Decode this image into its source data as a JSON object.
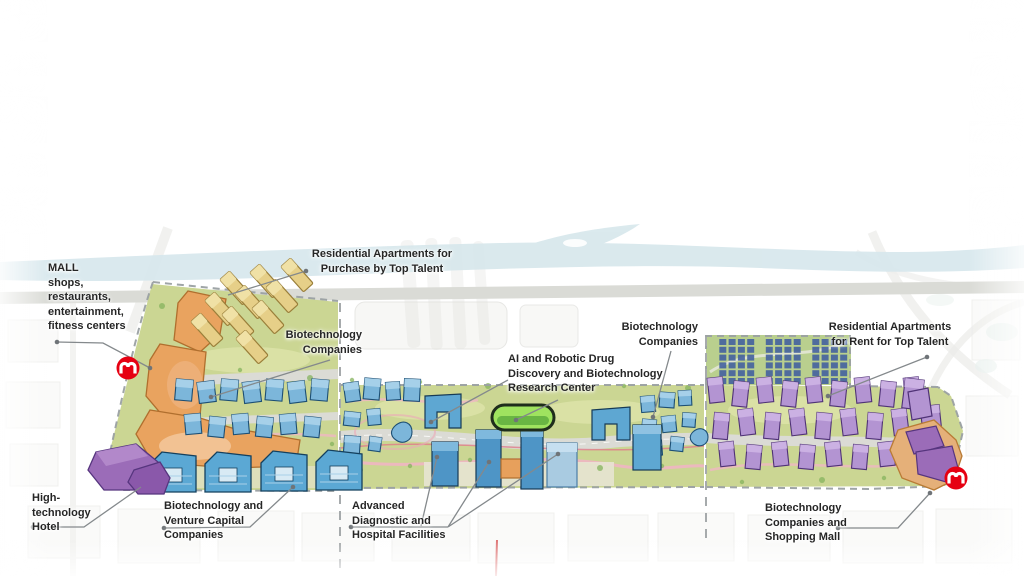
{
  "labels": {
    "mall": "MALL\nshops,\nrestaurants,\nentertainment,\nfitness centers",
    "residential_purchase": "Residential Apartments for\nPurchase by Top Talent",
    "biotech_left": "Biotechnology\nCompanies",
    "ai_research": "AI and Robotic Drug\nDiscovery and Biotechnology\nResearch Center",
    "biotech_right": "Biotechnology\nCompanies",
    "residential_rent": "Residential Apartments\nfor Rent for Top Talent",
    "hotel": "High-\ntechnology\nHotel",
    "biotech_venture": "Biotechnology and\nVenture Capital\nCompanies",
    "hospital": "Advanced\nDiagnostic and\nHospital Facilities",
    "biotech_mall": "Biotechnology\nCompanies and\nShopping Mall"
  },
  "icons": {
    "metro_station": "shanghai-metro-logo"
  },
  "palette": {
    "river_blue": "#d6e7ec",
    "site_green": "#cbd693",
    "solar_green": "#b9cf8e",
    "apartment_yellow": "#e6cf88",
    "mall_orange": "#e9a35f",
    "hotel_purple": "#9b6cb8",
    "office_blue": "#7cb6da",
    "building_blue": "#5ea7d2",
    "tower_blue": "#4e95c6",
    "residential_purple": "#b394d2",
    "research_green": "#9fe35f",
    "panel_blue": "#44619f",
    "metro_red": "#e60012",
    "annotation_gray": "#84898c"
  }
}
